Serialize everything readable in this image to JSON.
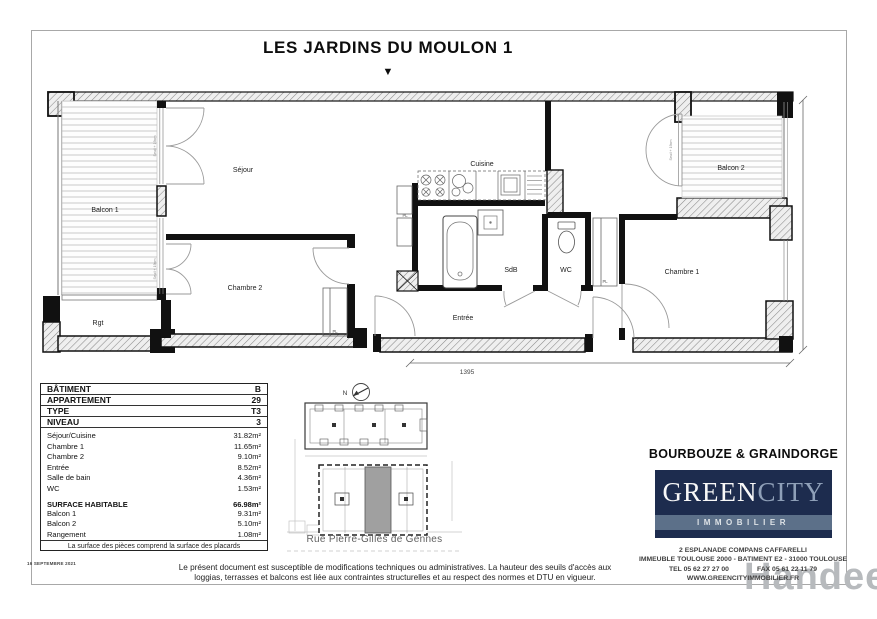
{
  "page": {
    "title": "LES JARDINS DU MOULON 1",
    "marker": "▼",
    "date_note": "16 SEPTEMBRE 2021",
    "watermark": "Handee",
    "watermark_color": "#b7babd"
  },
  "plan": {
    "rooms": {
      "balcon1": "Balcon 1",
      "rgt": "Rgt",
      "sejour": "Séjour",
      "chambre2": "Chambre 2",
      "cuisine": "Cuisine",
      "sdb": "SdB",
      "wc": "WC",
      "entree": "Entrée",
      "chambre1": "Chambre 1",
      "balcon2": "Balcon 2"
    },
    "annotations": {
      "pl": "PL",
      "seuil": "Seuil + 19cm"
    },
    "dimensions": {
      "width": "1395",
      "height": "547"
    }
  },
  "info_table": {
    "header_rows": [
      {
        "label": "BÂTIMENT",
        "value": "B"
      },
      {
        "label": "APPARTEMENT",
        "value": "29"
      },
      {
        "label": "TYPE",
        "value": "T3"
      },
      {
        "label": "NIVEAU",
        "value": "3"
      }
    ],
    "rooms": [
      {
        "label": "Séjour/Cuisine",
        "value": "31.82m²"
      },
      {
        "label": "Chambre 1",
        "value": "11.65m²"
      },
      {
        "label": "Chambre 2",
        "value": "9.10m²"
      },
      {
        "label": "Entrée",
        "value": "8.52m²"
      },
      {
        "label": "Salle de bain",
        "value": "4.36m²"
      },
      {
        "label": "WC",
        "value": "1.53m²"
      }
    ],
    "surface": {
      "label": "SURFACE HABITABLE",
      "value": "66.98m²"
    },
    "annexes": [
      {
        "label": "Balcon 1",
        "value": "9.31m²"
      },
      {
        "label": "Balcon 2",
        "value": "5.10m²"
      },
      {
        "label": "Rangement",
        "value": "1.08m²"
      }
    ],
    "footnote": "La surface des pièces comprend la surface des placards"
  },
  "site_plan": {
    "north": "N",
    "street": "Rue Pierre-Gilles de Gennes",
    "highlight_color": "#a0a0a0"
  },
  "branding": {
    "architect": "BOURBOUZE & GRAINDORGE",
    "logo": {
      "part1": "GREEN",
      "part2": "CITY",
      "tagline": "IMMOBILIER",
      "bg_color": "#1d2c4e",
      "band_color": "#5c7089",
      "city_color": "#8fa0b8"
    },
    "address_line1": "2 ESPLANADE COMPANS CAFFARELLI",
    "address_line2": "IMMEUBLE TOULOUSE 2000 - BATIMENT E2 - 31000 TOULOUSE",
    "tel": "TEL 05 62 27 27 00",
    "fax": "FAX 05 61 22 11 79",
    "website": "WWW.GREENCITYIMMOBILIER.FR"
  },
  "disclaimer": {
    "line1": "Le présent document est susceptible de modifications techniques ou administratives. La hauteur des seuils d'accès aux",
    "line2": "loggias, terrasses et balcons est liée aux contraintes structurelles et au respect des normes et DTU en vigueur."
  }
}
